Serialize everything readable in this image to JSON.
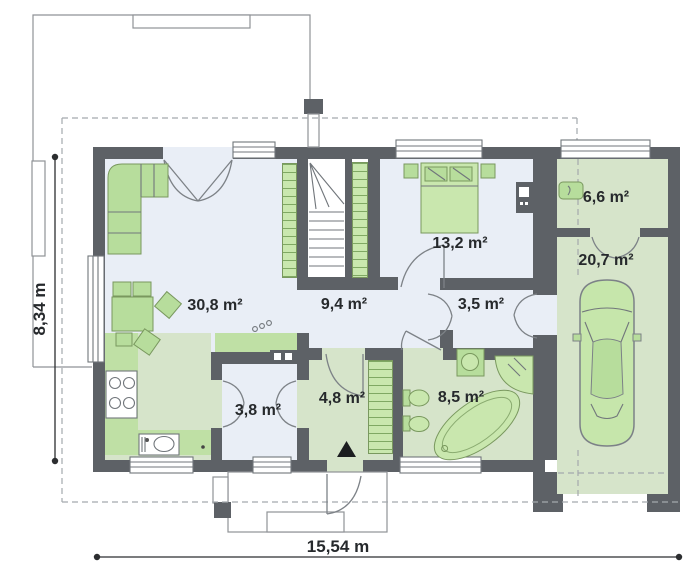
{
  "plan": {
    "rooms": [
      {
        "name": "living-room",
        "area": "30,8 m²"
      },
      {
        "name": "hallway",
        "area": "9,4 m²"
      },
      {
        "name": "bedroom",
        "area": "13,2 m²"
      },
      {
        "name": "corridor",
        "area": "3,5 m²"
      },
      {
        "name": "utility-room",
        "area": "6,6 m²"
      },
      {
        "name": "garage",
        "area": "20,7 m²"
      },
      {
        "name": "pantry",
        "area": "3,8 m²"
      },
      {
        "name": "vestibule",
        "area": "4,8 m²"
      },
      {
        "name": "bathroom",
        "area": "8,5 m²"
      }
    ],
    "dimensions": {
      "width": "15,54 m",
      "height": "8,34 m"
    },
    "colors": {
      "wall": "#5d6166",
      "floor_light": "#e9eef6",
      "floor_green": "#d6e4ca",
      "counter_green": "#bfe0a5",
      "furniture_green": "#b7dd9c",
      "furniture_dark_green": "#c9e7ae",
      "line": "#71767b",
      "outline": "#8f9296",
      "text": "#26292c"
    }
  }
}
